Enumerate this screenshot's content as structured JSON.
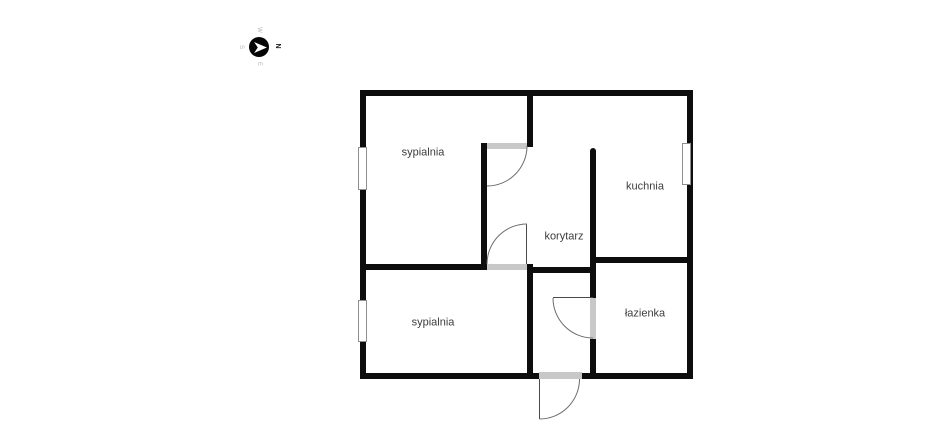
{
  "page": {
    "background": "#ffffff"
  },
  "compass": {
    "north": "N",
    "east": "E",
    "south": "S",
    "west": "W",
    "active_direction": "N",
    "needle_icon": "right-pointing-dart"
  },
  "palette": {
    "wall": "#0d0d0d",
    "door_threshold": "#c8c8c8",
    "window_border": "#8f8f8f",
    "door_arc": "#6e6e6e",
    "door_leaf": "#4a4a4a",
    "room_label": "#3c3c3c",
    "compass_circle": "#050505",
    "compass_needle": "#ffffff",
    "compass_active_letter": "#1a1a1a",
    "compass_inactive_letter": "#b4b4b4"
  },
  "rooms": [
    {
      "id": "sypialnia-1",
      "label": "sypialnia"
    },
    {
      "id": "kuchnia",
      "label": "kuchnia"
    },
    {
      "id": "korytarz",
      "label": "korytarz"
    },
    {
      "id": "sypialnia-2",
      "label": "sypialnia"
    },
    {
      "id": "lazienka",
      "label": "łazienka"
    }
  ]
}
